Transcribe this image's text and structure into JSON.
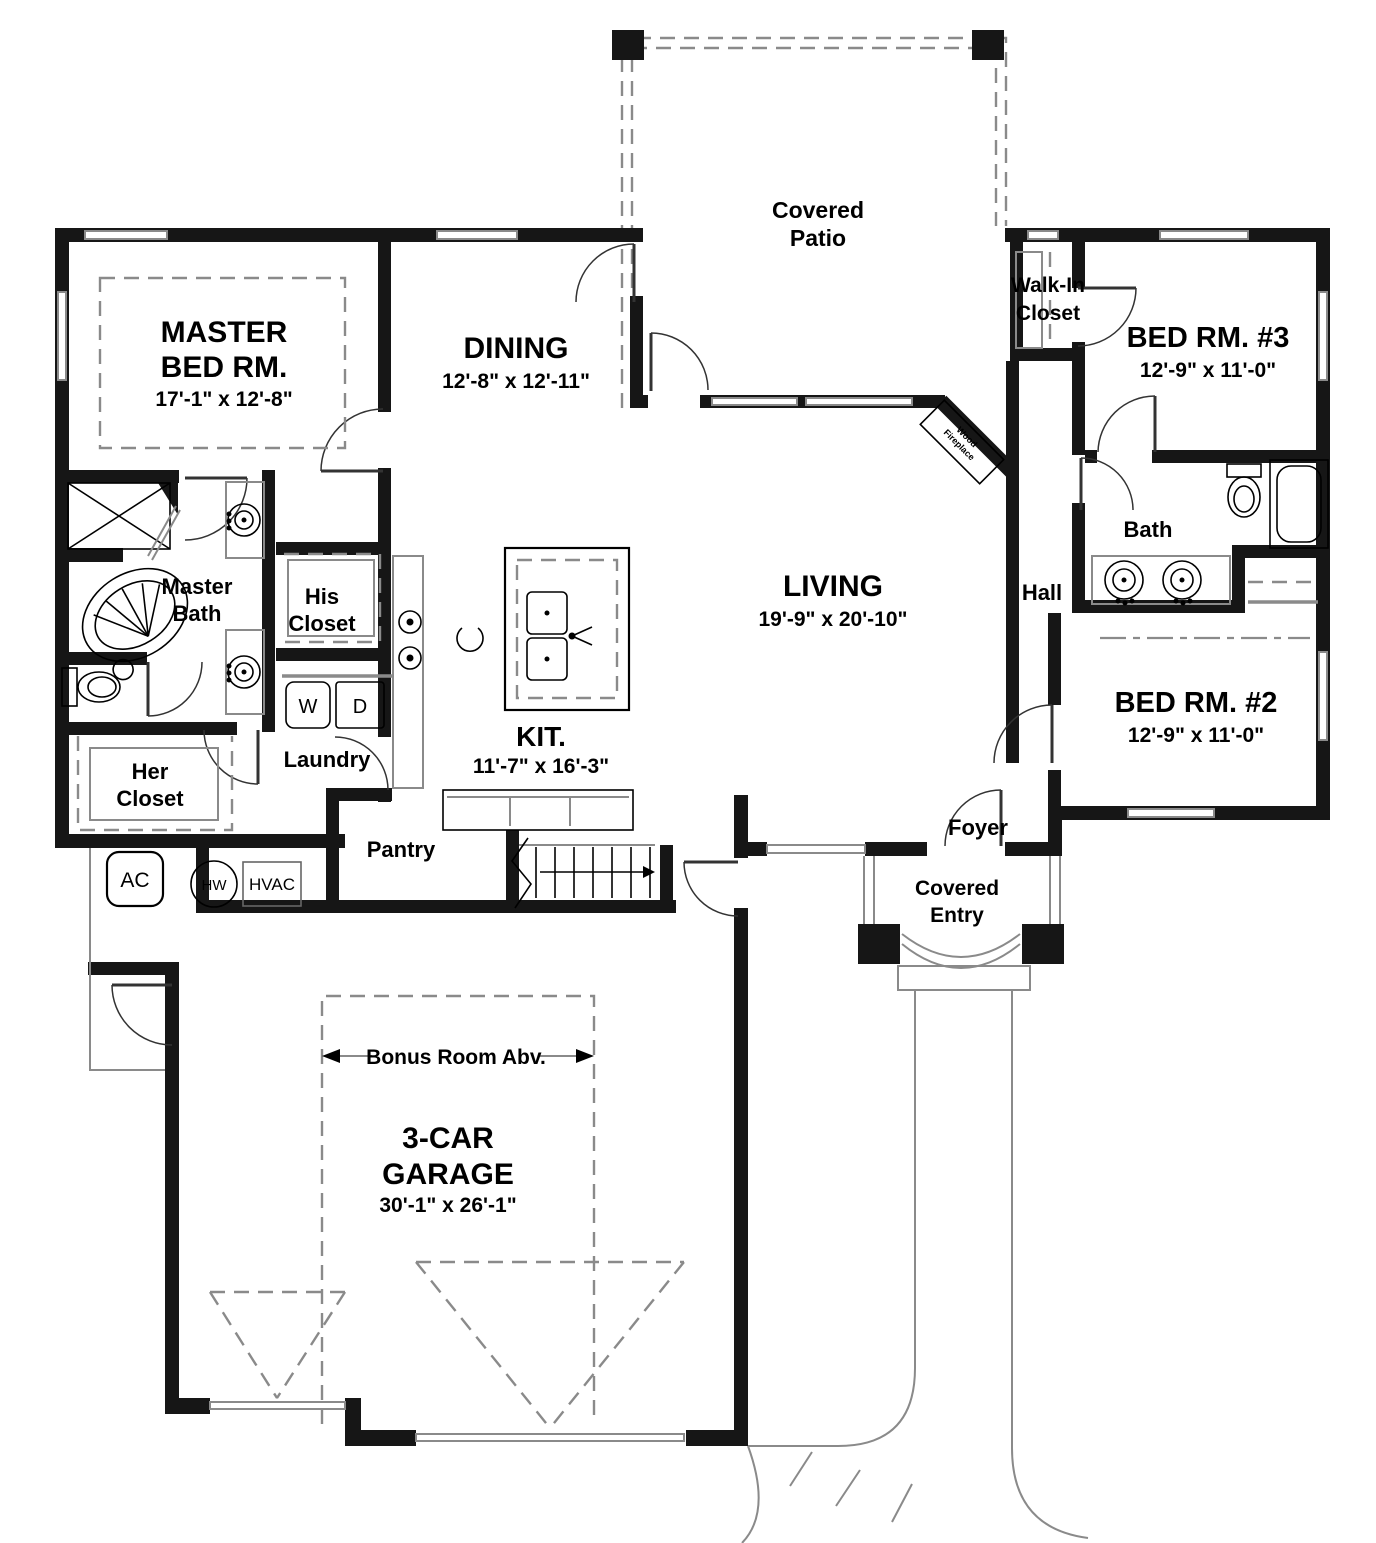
{
  "title": "First floor plan",
  "colors": {
    "wall": "#161616",
    "line": "#000000",
    "gray": "#8a8a8a",
    "background": "#ffffff"
  },
  "rooms": {
    "covered_patio": {
      "line1": "Covered",
      "line2": "Patio"
    },
    "walk_in_closet": {
      "line1": "Walk-In",
      "line2": "Closet"
    },
    "bed_rm_3": {
      "name": "BED RM. #3",
      "dims": "12'-9\" x 11'-0\""
    },
    "master_bed_rm": {
      "line1": "MASTER",
      "line2": "BED RM.",
      "dims": "17'-1\" x 12'-8\""
    },
    "dining": {
      "name": "DINING",
      "dims": "12'-8\" x 12'-11\""
    },
    "living": {
      "name": "LIVING",
      "dims": "19'-9\" x 20'-10\""
    },
    "kitchen": {
      "name": "KIT.",
      "dims": "11'-7\" x 16'-3\""
    },
    "bed_rm_2": {
      "name": "BED RM. #2",
      "dims": "12'-9\" x 11'-0\""
    },
    "garage": {
      "line1": "3-CAR",
      "line2": "GARAGE",
      "dims": "30'-1\" x 26'-1\""
    },
    "master_bath": {
      "line1": "Master",
      "line2": "Bath"
    },
    "his_closet": {
      "line1": "His",
      "line2": "Closet"
    },
    "her_closet": {
      "line1": "Her",
      "line2": "Closet"
    },
    "laundry": {
      "name": "Laundry"
    },
    "pantry": {
      "name": "Pantry"
    },
    "bath": {
      "name": "Bath"
    },
    "hall": {
      "name": "Hall"
    },
    "foyer": {
      "name": "Foyer"
    },
    "covered_entry": {
      "line1": "Covered",
      "line2": "Entry"
    },
    "bonus_room": {
      "name": "Bonus Room Abv."
    }
  },
  "appliances": {
    "washer": "W",
    "dryer": "D",
    "ac": "AC",
    "water_heater": "HW",
    "hvac": "HVAC"
  },
  "fireplace": {
    "line1": "Wood",
    "line2": "Fireplace"
  }
}
